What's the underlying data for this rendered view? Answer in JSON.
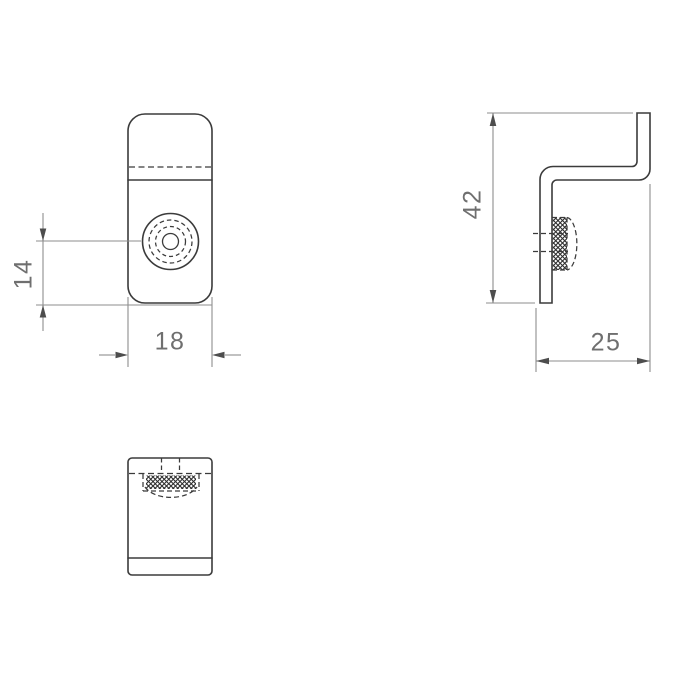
{
  "views": {
    "front": {
      "dim_hole_to_bottom": "14",
      "dim_width": "18"
    },
    "side": {
      "dim_height": "42",
      "dim_depth": "25"
    }
  },
  "colors": {
    "background": "#ffffff",
    "part_outline": "#3b3b3b",
    "hidden_line": "#3b3b3b",
    "dimension_line": "#8e8e8e",
    "arrow": "#4d4d4d",
    "dimension_text": "#6f6f6f"
  }
}
